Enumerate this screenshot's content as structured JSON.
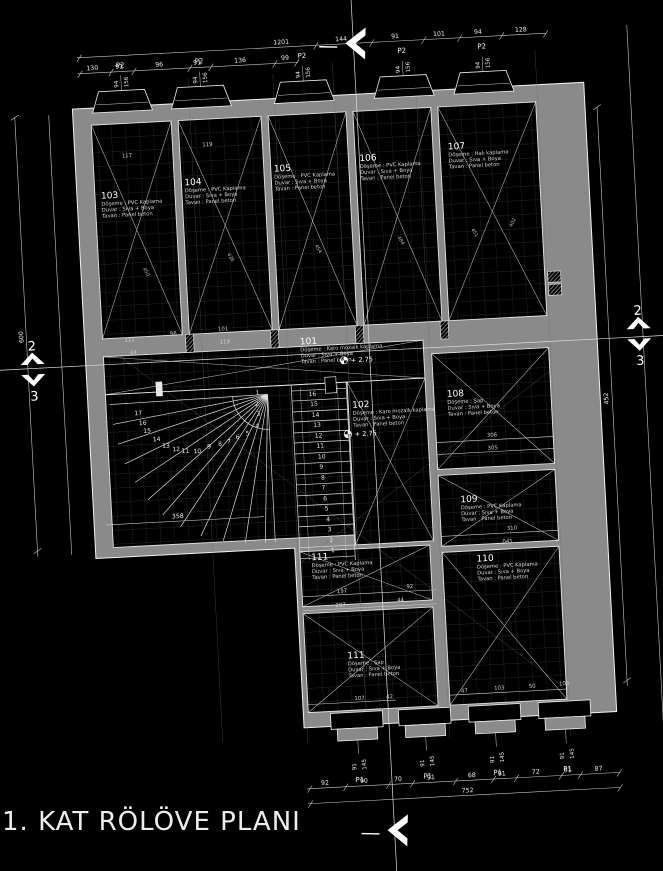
{
  "title": "1. KAT RÖLÖVE PLANI",
  "colors": {
    "background": "#000000",
    "wall": "#8a8a8a",
    "line": "#ffffff",
    "accent": "#4d7ea6"
  },
  "section_marks": {
    "top": "2",
    "bottom": "3"
  },
  "levels": {
    "l101": "+ 2.75",
    "l102": "+ 2.75"
  },
  "windows": {
    "top": {
      "label": "P2",
      "w": "94",
      "h": "156"
    },
    "bottom": {
      "label": "P1",
      "w": "91",
      "h": "145"
    }
  },
  "rooms": {
    "r101": {
      "no": "101",
      "floor": "Döşeme : Karo mozaik kaplama",
      "wall": "Duvar : Sıva + Boya",
      "ceil": "Tavan : Panel beton"
    },
    "r102": {
      "no": "102",
      "floor": "Döşeme : Karo mozaik kaplama",
      "wall": "Duvar : Sıva + Boya",
      "ceil": "Tavan : Panel beton"
    },
    "r103": {
      "no": "103",
      "floor": "Döşeme : PVC Kaplama",
      "wall": "Duvar : Sıva + Boya",
      "ceil": "Tavan : Panel beton"
    },
    "r104": {
      "no": "104",
      "floor": "Döşeme : PVC Kaplama",
      "wall": "Duvar : Sıva + Boya",
      "ceil": "Tavan : Panel beton"
    },
    "r105": {
      "no": "105",
      "floor": "Döşeme : PVC Kaplama",
      "wall": "Duvar : Sıva + Boya",
      "ceil": "Tavan : Panel beton"
    },
    "r106": {
      "no": "106",
      "floor": "Döşeme : PVC Kaplama",
      "wall": "Duvar : Sıva + Boya",
      "ceil": "Tavan : Panel beton"
    },
    "r107": {
      "no": "107",
      "floor": "Döşeme : Halı kaplama",
      "wall": "Duvar : Sıva + Boya",
      "ceil": "Tavan : Panel beton"
    },
    "r108": {
      "no": "108",
      "floor": "Döşeme : Şap",
      "wall": "Duvar : Sıva + Boya",
      "ceil": "Tavan : Panel beton"
    },
    "r109": {
      "no": "109",
      "floor": "Döşeme : PVC Kaplama",
      "wall": "Duvar : Sıva + Boya",
      "ceil": "Tavan : Panel beton"
    },
    "r110": {
      "no": "110",
      "floor": "Döşeme : PVC Kaplama",
      "wall": "Duvar : Sıva + Boya",
      "ceil": "Tavan : Panel beton"
    },
    "r111a": {
      "no": "111",
      "floor": "Döşeme : PVC Kaplama",
      "wall": "Duvar : Sıva + Boya",
      "ceil": "Tavan : Panel beton"
    },
    "r111b": {
      "no": "111",
      "floor": "Döşeme : Şap",
      "wall": "Duvar : Sıva + Boya",
      "ceil": "Tavan : Panel beton"
    }
  },
  "dims": {
    "top_upper": [
      "1201",
      "144",
      "91",
      "101",
      "94",
      "128"
    ],
    "top_lower": [
      "130",
      "91",
      "96",
      "91",
      "136",
      "99"
    ],
    "bottom": [
      "92",
      "90",
      "70",
      "91",
      "68",
      "91",
      "72",
      "91",
      "87"
    ],
    "bottom_total": "752",
    "left_total": "600",
    "right_total": "452",
    "stair_width": "358",
    "inner": [
      "306",
      "305",
      "310",
      "197",
      "207",
      "92",
      "44",
      "041",
      "111",
      "96",
      "101",
      "119",
      "44",
      "117",
      "119",
      "47",
      "103",
      "50",
      "103",
      "107",
      "42"
    ],
    "diagonals": [
      "450",
      "438",
      "454",
      "484",
      "451",
      "402"
    ]
  },
  "stairs": {
    "winder": [
      "1",
      "2",
      "3",
      "4",
      "5",
      "6",
      "7",
      "8",
      "9",
      "10",
      "11",
      "12",
      "13",
      "14",
      "15",
      "16",
      "17"
    ],
    "straight": [
      "1",
      "2",
      "3",
      "4",
      "5",
      "6",
      "7",
      "8",
      "9",
      "10",
      "11",
      "12",
      "13",
      "14",
      "15",
      "16"
    ]
  }
}
